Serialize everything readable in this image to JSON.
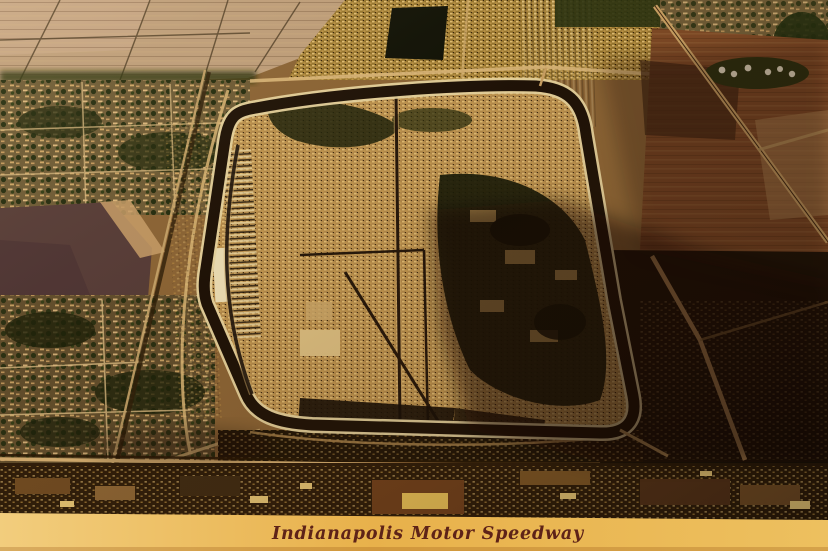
{
  "postcard": {
    "caption": "Indianapolis Motor Speedway",
    "scene_alt": "Vintage sepia aerial photograph of the Indianapolis Motor Speedway oval track, its car-filled infield and parking lots, surrounded by neighborhoods, farmland and roads, with a golden caption band along the bottom"
  },
  "palette": {
    "band_gold_left": "#f2cd7d",
    "band_gold_mid": "#e8b14b",
    "band_gold_right": "#edc05f",
    "caption_maroon": "#5e2318",
    "track_asphalt": "#190f06",
    "track_edge_light": "#e9d7a2",
    "infield_base": "#b28a4c",
    "farmland_tan": "#bfa07e",
    "field_red": "#7c4826",
    "trees_dark": "#25300f",
    "shadow_dark": "#070402"
  }
}
